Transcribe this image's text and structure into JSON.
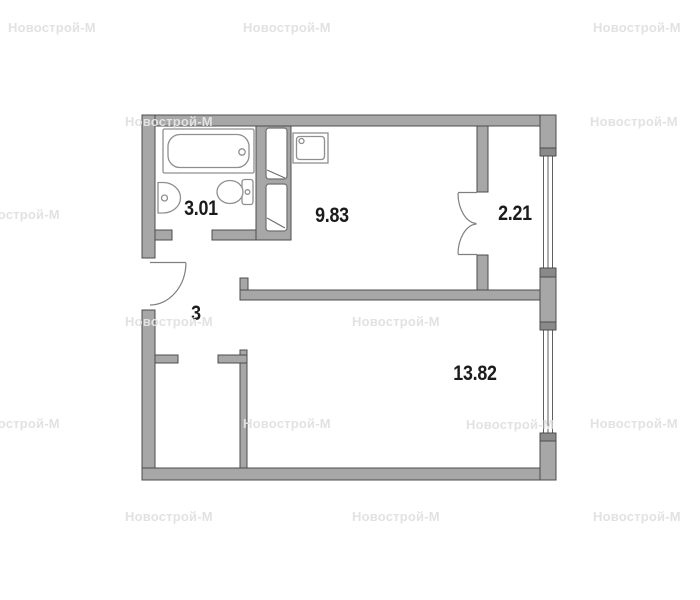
{
  "floor_plan": {
    "watermark": {
      "text": "Новострой-М"
    },
    "rooms": [
      {
        "id": "bathroom",
        "area": "3.01"
      },
      {
        "id": "kitchen",
        "area": "9.83"
      },
      {
        "id": "balcony",
        "area": "2.21"
      },
      {
        "id": "hallway",
        "area": "3"
      },
      {
        "id": "living-room",
        "area": "13.82"
      }
    ],
    "fixtures": [
      "bathtub",
      "washbasin",
      "toilet",
      "sink",
      "vent-shaft",
      "entrance-door",
      "double-door",
      "window",
      "window"
    ],
    "colors": {
      "wall_fill": "#a7a7a7",
      "wall_outline": "#4c4c4c",
      "window_sill": "#8a8a8a",
      "fixture_line": "#8f8f8f",
      "door_line": "#7f7f7f",
      "label_text": "#1b1b1b",
      "watermark_text": "#e2e2e2",
      "background": "#ffffff"
    }
  }
}
